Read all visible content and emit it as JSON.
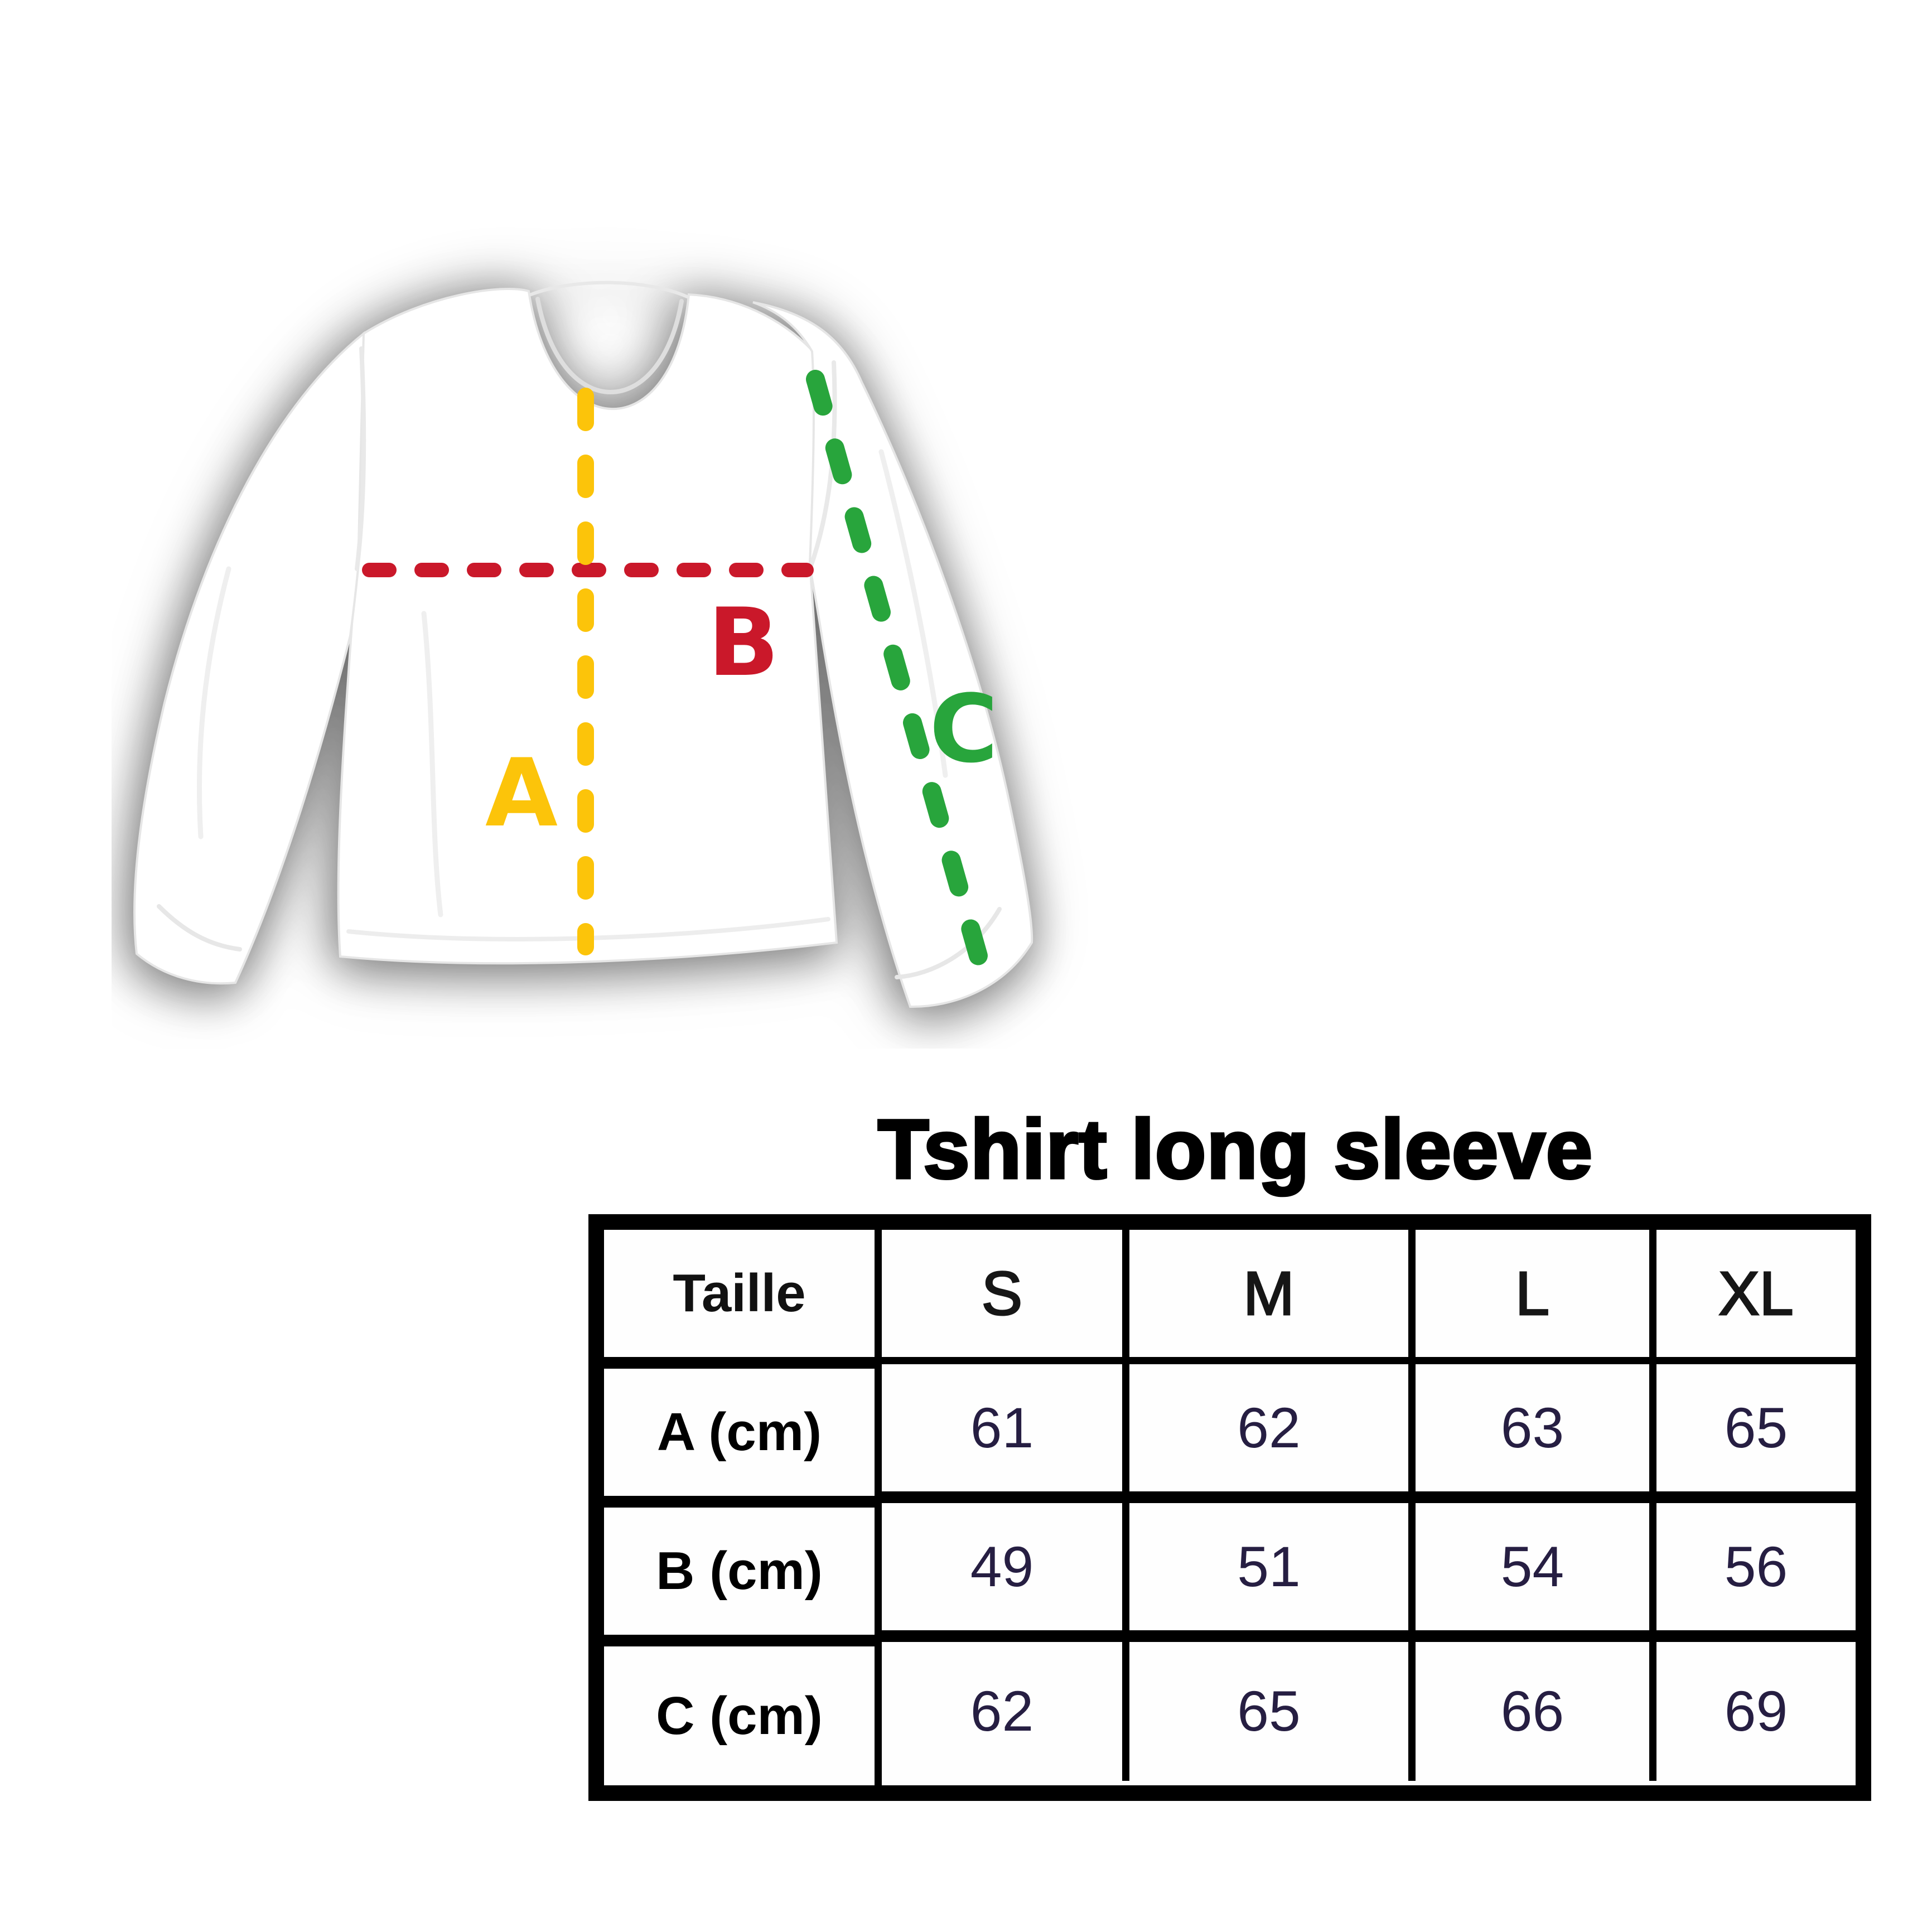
{
  "title": "Tshirt long sleeve",
  "diagram": {
    "garment": "white long sleeve t-shirt, front view",
    "measurements": [
      {
        "label": "A",
        "color": "#FCC40A",
        "line": "vertical dashed line from collar to hem"
      },
      {
        "label": "B",
        "color": "#CA182A",
        "line": "horizontal dashed line across chest"
      },
      {
        "label": "C",
        "color": "#28A53C",
        "line": "diagonal dashed line along sleeve"
      }
    ]
  },
  "size_table": {
    "header": [
      "Taille",
      "S",
      "M",
      "L",
      "XL"
    ],
    "rows": [
      {
        "label": "A (cm)",
        "values": [
          "61",
          "62",
          "63",
          "65"
        ]
      },
      {
        "label": "B (cm)",
        "values": [
          "49",
          "51",
          "54",
          "56"
        ]
      },
      {
        "label": "C (cm)",
        "values": [
          "62",
          "65",
          "66",
          "69"
        ]
      }
    ],
    "colors": {
      "border": "#000000",
      "number_text": "#261E42"
    }
  }
}
